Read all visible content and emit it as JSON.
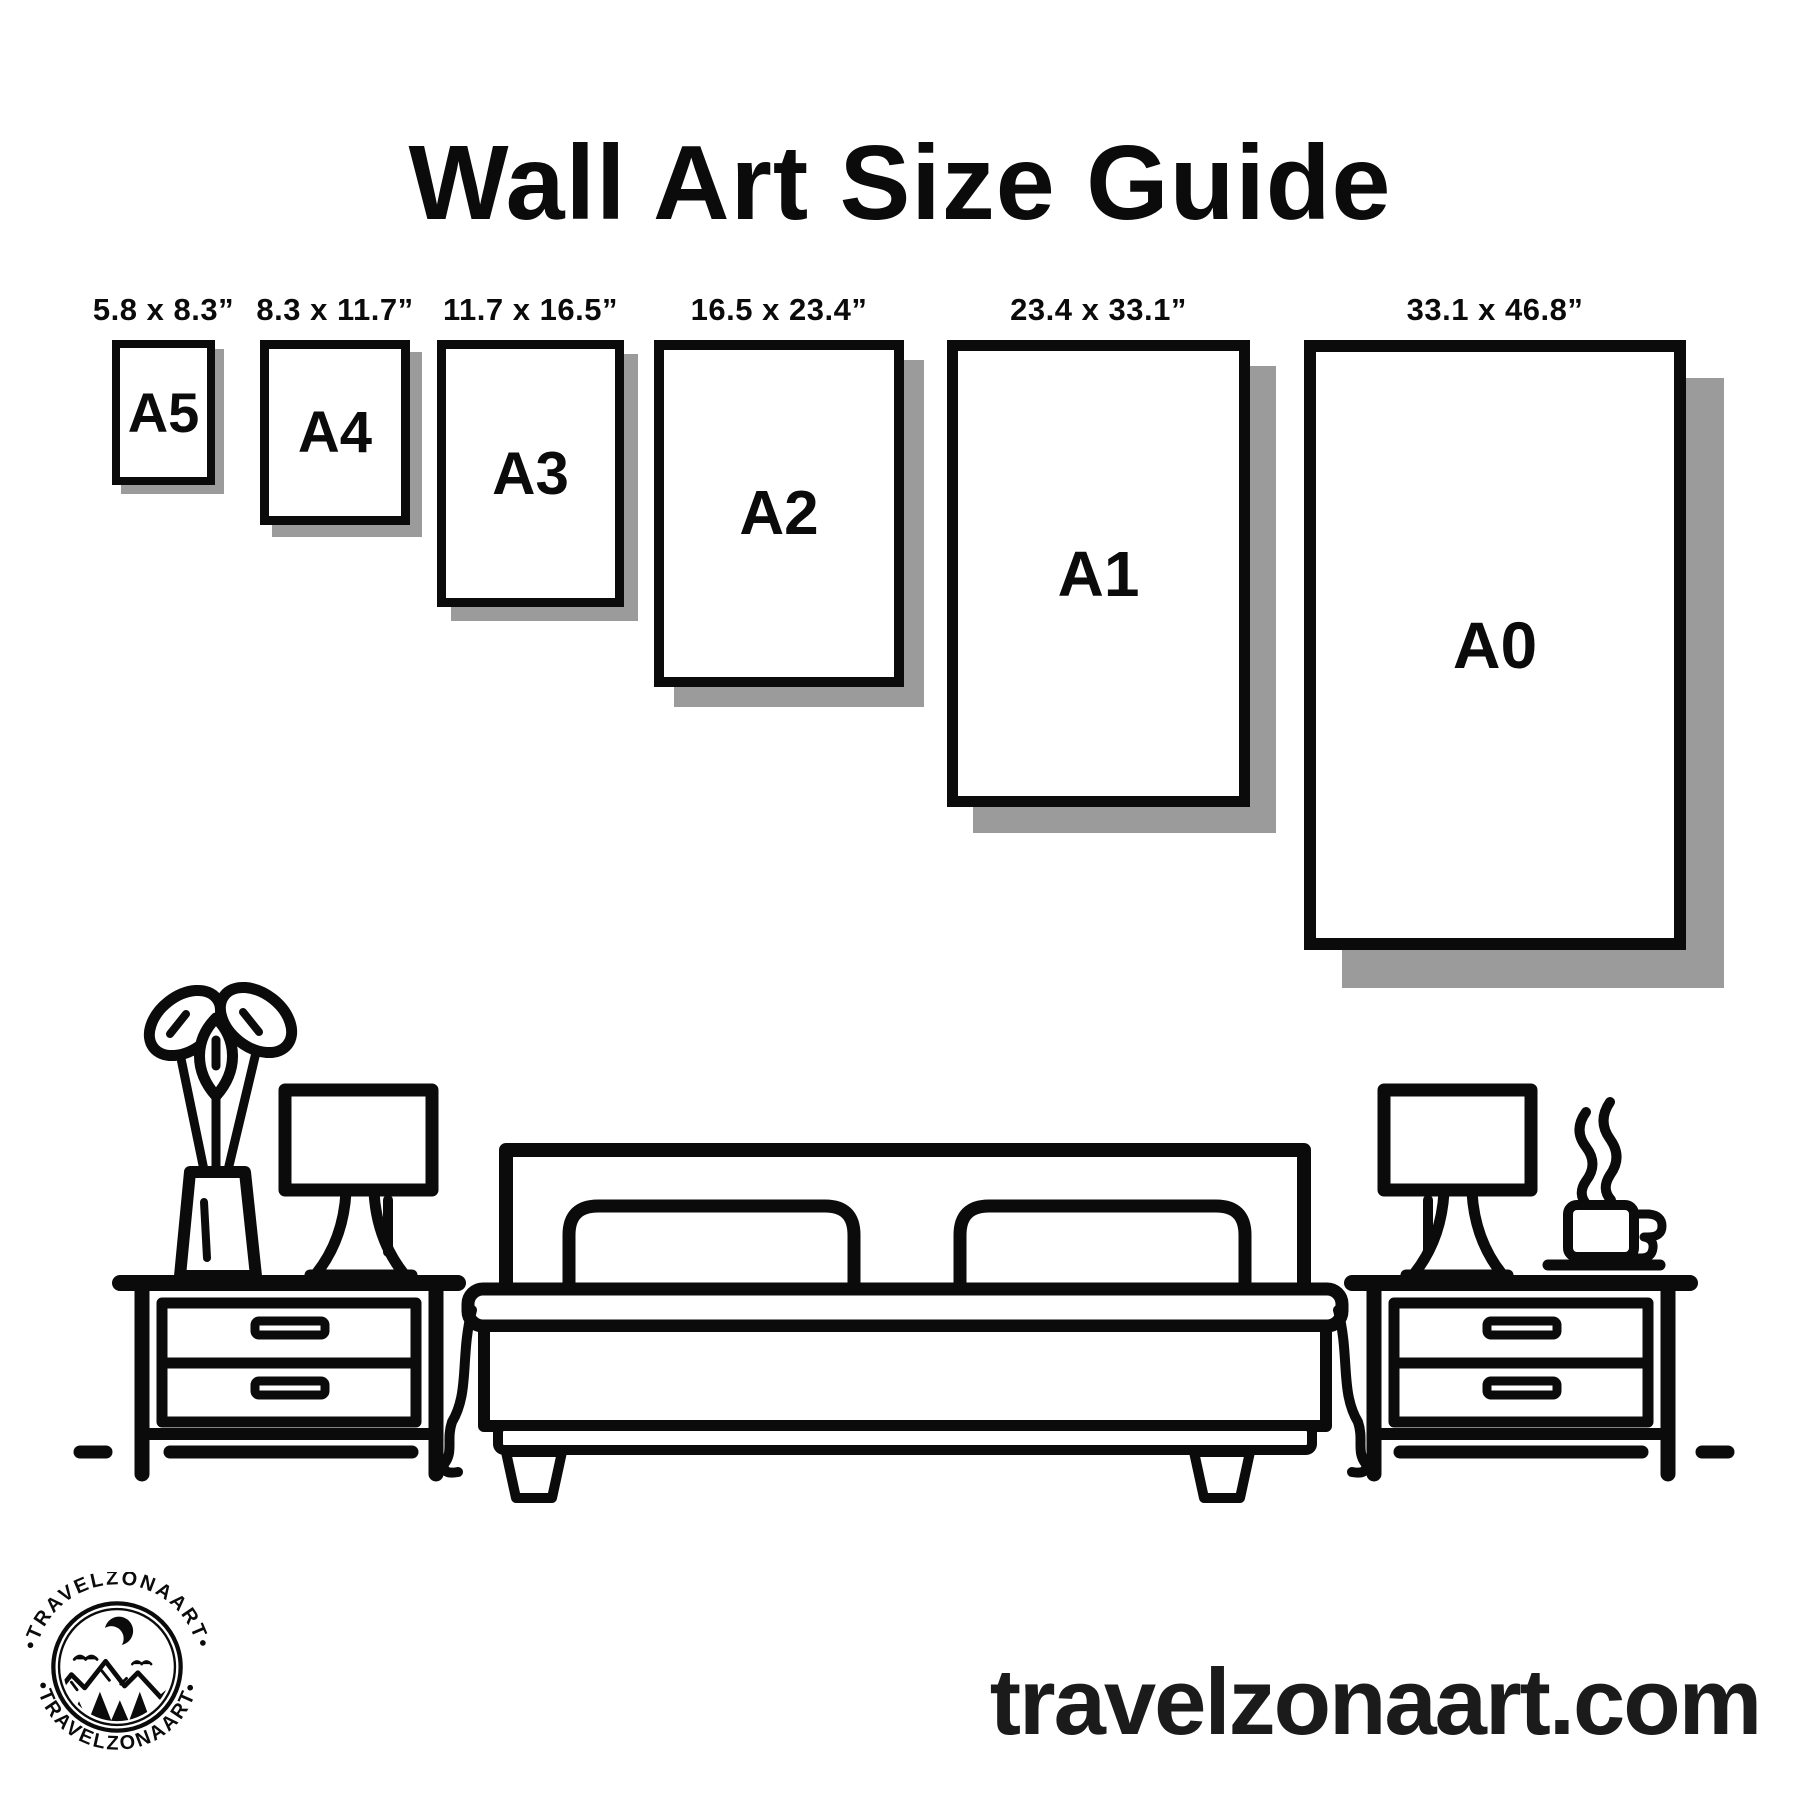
{
  "title": "Wall Art Size Guide",
  "colors": {
    "ink": "#0b0b0b",
    "shadow": "#9b9b9b",
    "website_text": "#1b1b1b",
    "background": "#ffffff"
  },
  "frames": [
    {
      "name": "A5",
      "dimensions": "5.8 x 8.3”",
      "left": 112,
      "top": 340,
      "width": 103,
      "height": 145,
      "border": 8,
      "shadow_offset": 9,
      "font": 56
    },
    {
      "name": "A4",
      "dimensions": "8.3 x 11.7”",
      "left": 260,
      "top": 340,
      "width": 150,
      "height": 185,
      "border": 9,
      "shadow_offset": 12,
      "font": 58
    },
    {
      "name": "A3",
      "dimensions": "11.7 x 16.5”",
      "left": 437,
      "top": 340,
      "width": 187,
      "height": 267,
      "border": 9,
      "shadow_offset": 14,
      "font": 60
    },
    {
      "name": "A2",
      "dimensions": "16.5 x 23.4”",
      "left": 654,
      "top": 340,
      "width": 250,
      "height": 347,
      "border": 10,
      "shadow_offset": 20,
      "font": 62
    },
    {
      "name": "A1",
      "dimensions": "23.4 x 33.1”",
      "left": 947,
      "top": 340,
      "width": 303,
      "height": 467,
      "border": 11,
      "shadow_offset": 26,
      "font": 64
    },
    {
      "name": "A0",
      "dimensions": "33.1 x 46.8”",
      "left": 1304,
      "top": 340,
      "width": 382,
      "height": 610,
      "border": 12,
      "shadow_offset": 38,
      "font": 66
    }
  ],
  "logo": {
    "arc_top": "•TRAVELZONAART•",
    "arc_bottom": "•TRAVELZONAART•"
  },
  "website": "travelzonaart.com"
}
